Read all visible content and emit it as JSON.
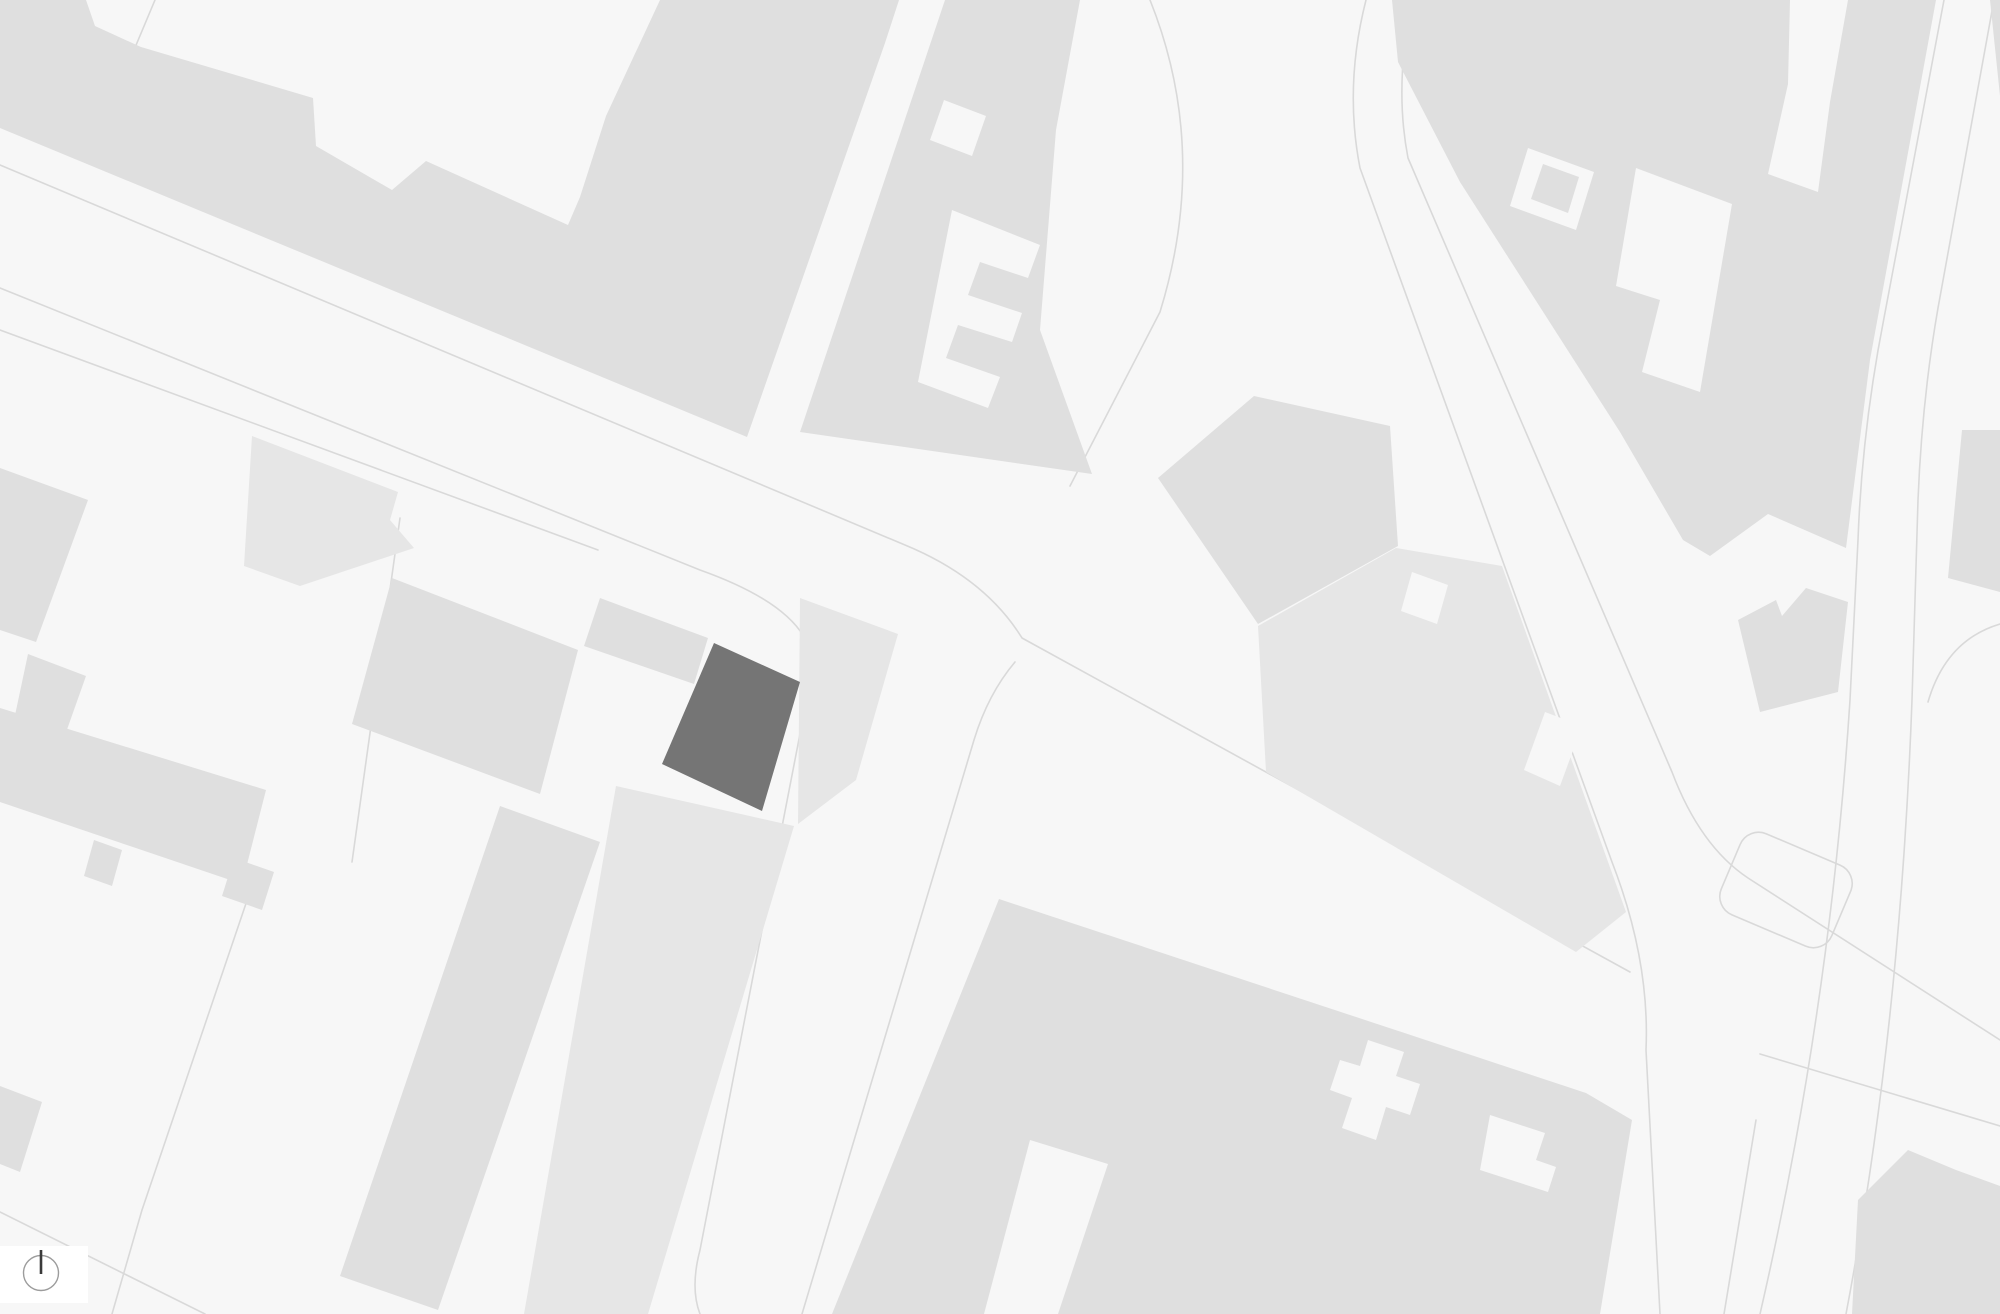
{
  "app": {
    "type": "figure-ground site plan map",
    "description": "Monochrome urban map with light gray building blocks on off-white streets, one building highlighted in dark gray, north indicator badge at bottom left"
  },
  "colors": {
    "bg": "#f7f7f7",
    "building": "#dfdfdf",
    "building_alt": "#e6e6e6",
    "highlight": "#757575",
    "line": "#d9d9d9",
    "card": "#ffffff",
    "compass_ring": "#9c9c9c",
    "compass_needle": "#3a3a3a"
  },
  "north_indicator": {
    "icon": "north-arrow-icon",
    "shape": "circle with vertical north needle on white card"
  },
  "map": {
    "highlighted_building_count": 1,
    "orientation": "street grid rotated roughly 23 degrees",
    "visible_text": ""
  }
}
